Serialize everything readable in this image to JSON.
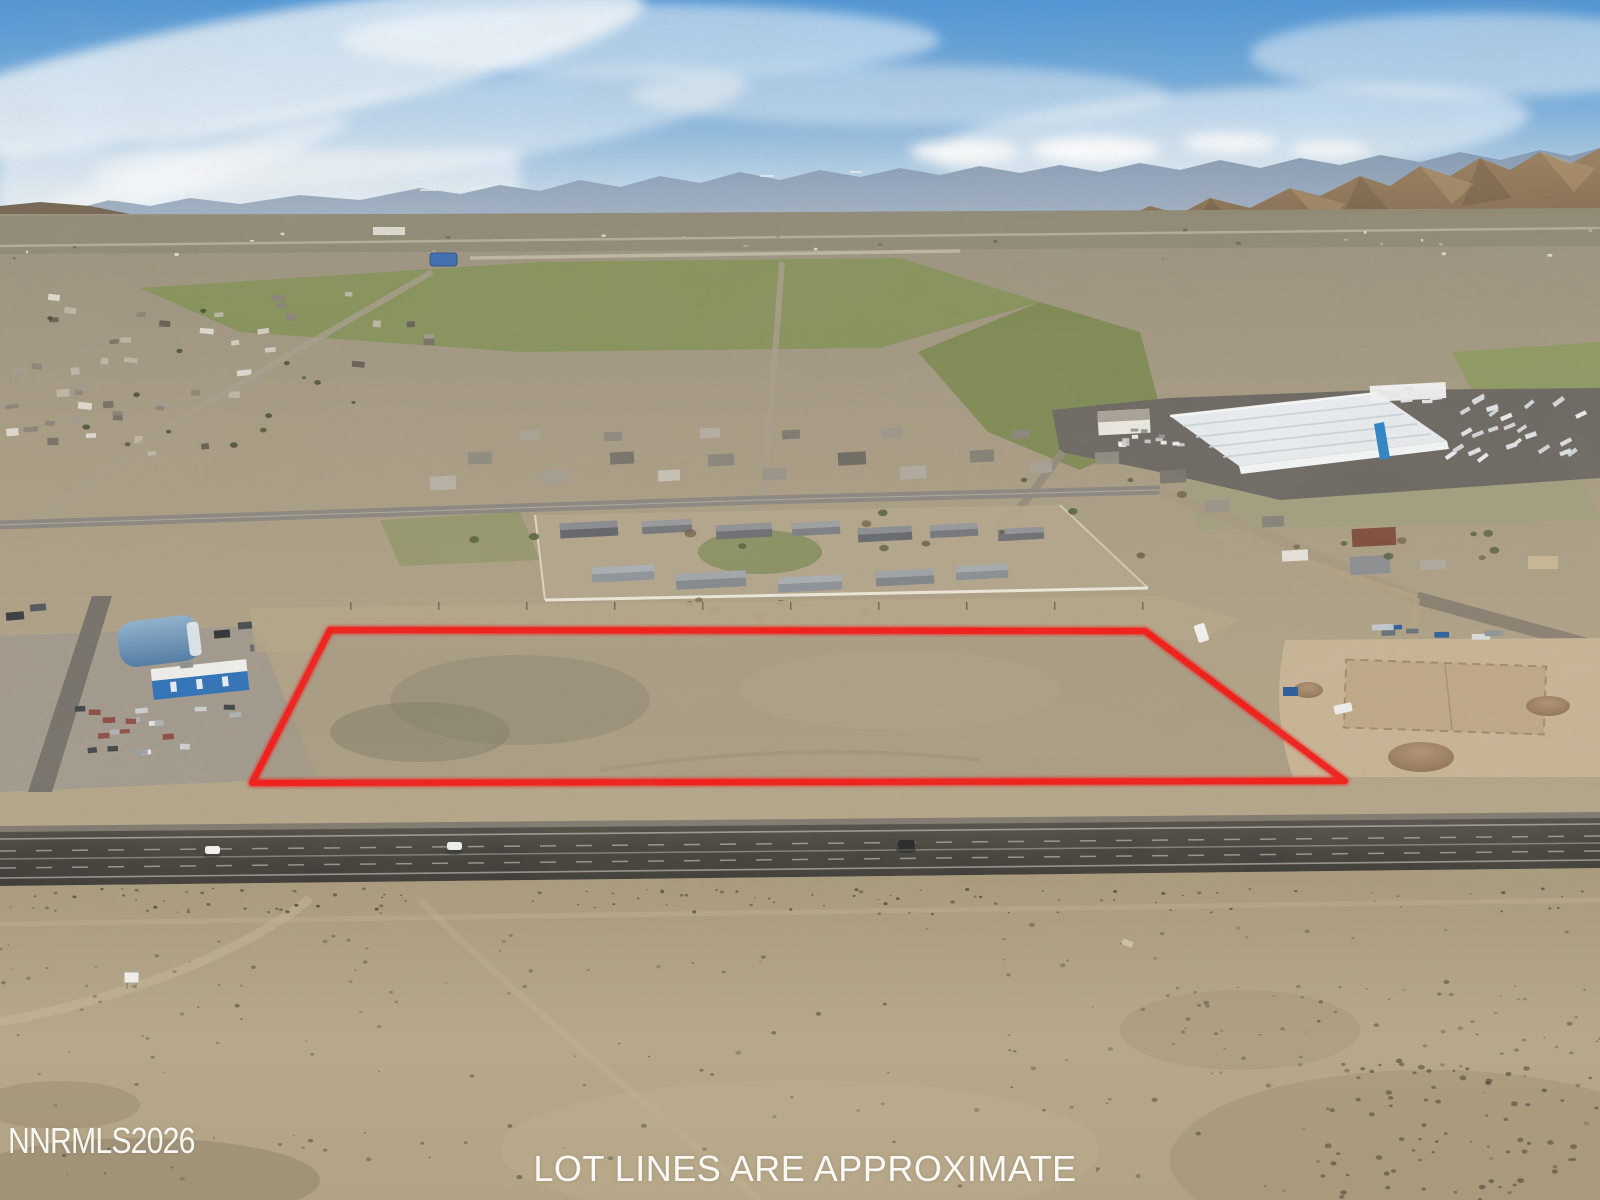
{
  "photo": {
    "type": "aerial-drone-photo",
    "subject": "vacant desert land parcel outlined in red beside a highway, small town, warehouse and mountains beyond",
    "watermark": "NNRMLS2026",
    "caption": "LOT LINES ARE APPROXIMATE",
    "lot_outline": {
      "color": "#f21e1a",
      "points": "330,630 1145,631 1345,781 252,783"
    }
  }
}
